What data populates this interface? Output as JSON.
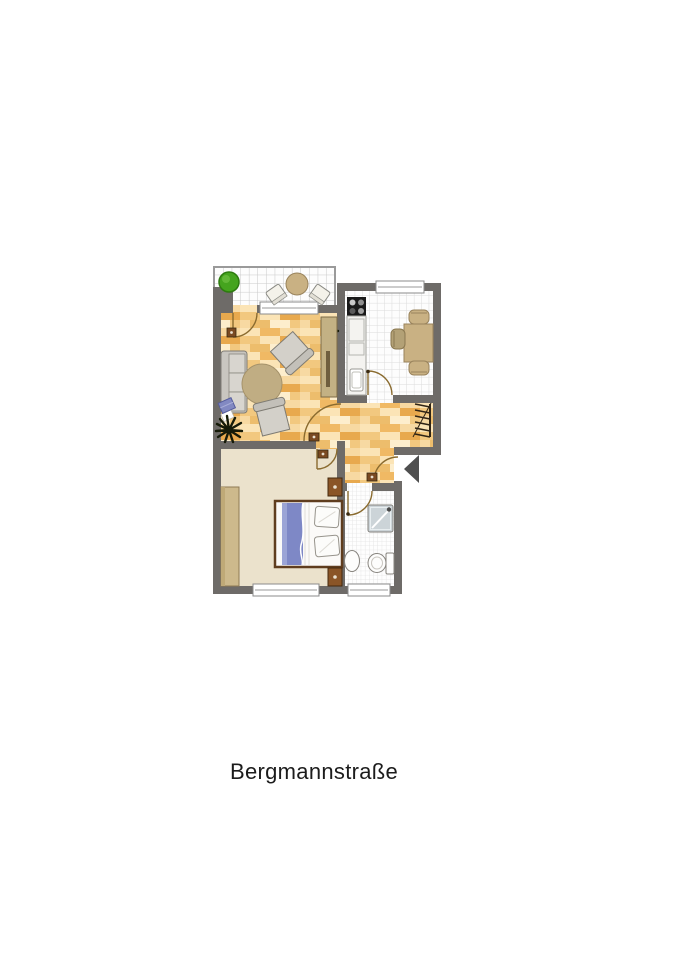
{
  "title": {
    "label": "Bergmannstraße"
  },
  "floorplan": {
    "type": "apartment-floor-plan",
    "entrance_marker": "black-triangle-pointing-left",
    "rooms": [
      {
        "name": "balcony",
        "floor": "tile",
        "furniture": [
          "green-bush",
          "round-table",
          "chair",
          "chair"
        ]
      },
      {
        "name": "living-room",
        "floor": "wood",
        "furniture": [
          "sofa",
          "laptop-on-sofa",
          "round-rug",
          "armchair",
          "armchair",
          "palm-plant",
          "small-plant",
          "cabinet"
        ],
        "openings": [
          "balcony-door",
          "window",
          "hallway-door"
        ]
      },
      {
        "name": "kitchen",
        "floor": "tile",
        "furniture": [
          "stove",
          "counter-with-sink",
          "dining-table",
          "chair",
          "chair",
          "chair"
        ],
        "openings": [
          "window",
          "hallway-door"
        ]
      },
      {
        "name": "hallway",
        "floor": "wood",
        "furniture": [
          "coat-rack"
        ],
        "openings": [
          "entrance-door",
          "kitchen-door",
          "living-room-door",
          "bedroom-door",
          "bathroom-door"
        ]
      },
      {
        "name": "bedroom",
        "floor": "carpet",
        "furniture": [
          "double-bed",
          "nightstand",
          "nightstand",
          "wardrobe"
        ],
        "openings": [
          "window",
          "hallway-door"
        ]
      },
      {
        "name": "bathroom",
        "floor": "tile",
        "furniture": [
          "shower",
          "sink",
          "toilet"
        ],
        "openings": [
          "window",
          "hallway-door"
        ]
      }
    ],
    "colors": {
      "wall": "#6e6b68",
      "wood_base": "#f7d49b",
      "wood_dark": "#e8a94e",
      "wood_light": "#fdeecd",
      "carpet": "#ebe2cc",
      "kitchen_tile_line": "#dcdcdc",
      "bath_tile_line": "#e3e3e3",
      "balcony_tile_line": "#c9c9c9",
      "furniture_tan": "#c9b183",
      "furniture_gray": "#d3d0c9",
      "wood_furniture_brown": "#8a5527",
      "bed_blue": "#7e88c6",
      "plant_green": "#45a41e",
      "door_arc": "#8a6b2f",
      "entrance_triangle": "#4f4f4f",
      "text": "#1c1c1c"
    }
  }
}
